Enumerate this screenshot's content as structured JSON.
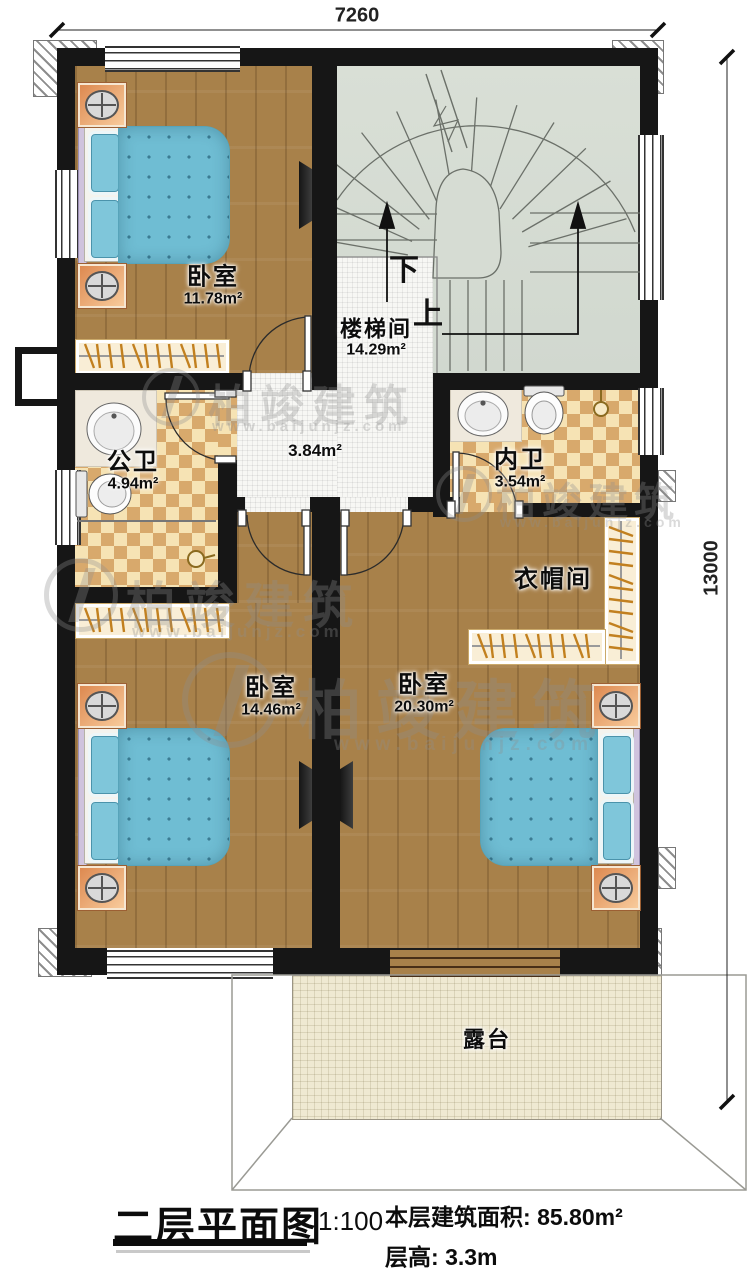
{
  "dimensions": {
    "width_mm": "7260",
    "height_mm": "13000"
  },
  "rooms": {
    "bedroom_top": {
      "name": "卧室",
      "area": "11.78m²"
    },
    "stairwell": {
      "name": "楼梯间",
      "area": "14.29m²",
      "down": "下",
      "up": "上"
    },
    "hallway": {
      "area": "3.84m²"
    },
    "public_bathroom": {
      "name": "公卫",
      "area": "4.94m²"
    },
    "ensuite_bathroom": {
      "name": "内卫",
      "area": "3.54m²"
    },
    "cloakroom": {
      "name": "衣帽间"
    },
    "bedroom_left": {
      "name": "卧室",
      "area": "14.46m²"
    },
    "bedroom_right": {
      "name": "卧室",
      "area": "20.30m²"
    },
    "terrace": {
      "name": "露台"
    }
  },
  "title_block": {
    "title": "二层平面图",
    "scale": "1:100",
    "floor_area_label": "本层建筑面积:",
    "floor_area_value": "85.80m²",
    "floor_height_label": "层高:",
    "floor_height_value": "3.3m"
  },
  "watermark": {
    "brand": "柏竣建筑",
    "url": "www.baijunjz.com"
  },
  "colors": {
    "wall": "#161616",
    "wood": "#a8814a",
    "stair_floor": "#d6dcd3",
    "checker_light": "#f6e3b4",
    "checker_dark": "#d8a96c",
    "hall_tile": "#f7f7f4",
    "terrace": "#efe9d2",
    "bed_blue": "#6fbdd3",
    "nightstand_orange": "#e8965e"
  }
}
